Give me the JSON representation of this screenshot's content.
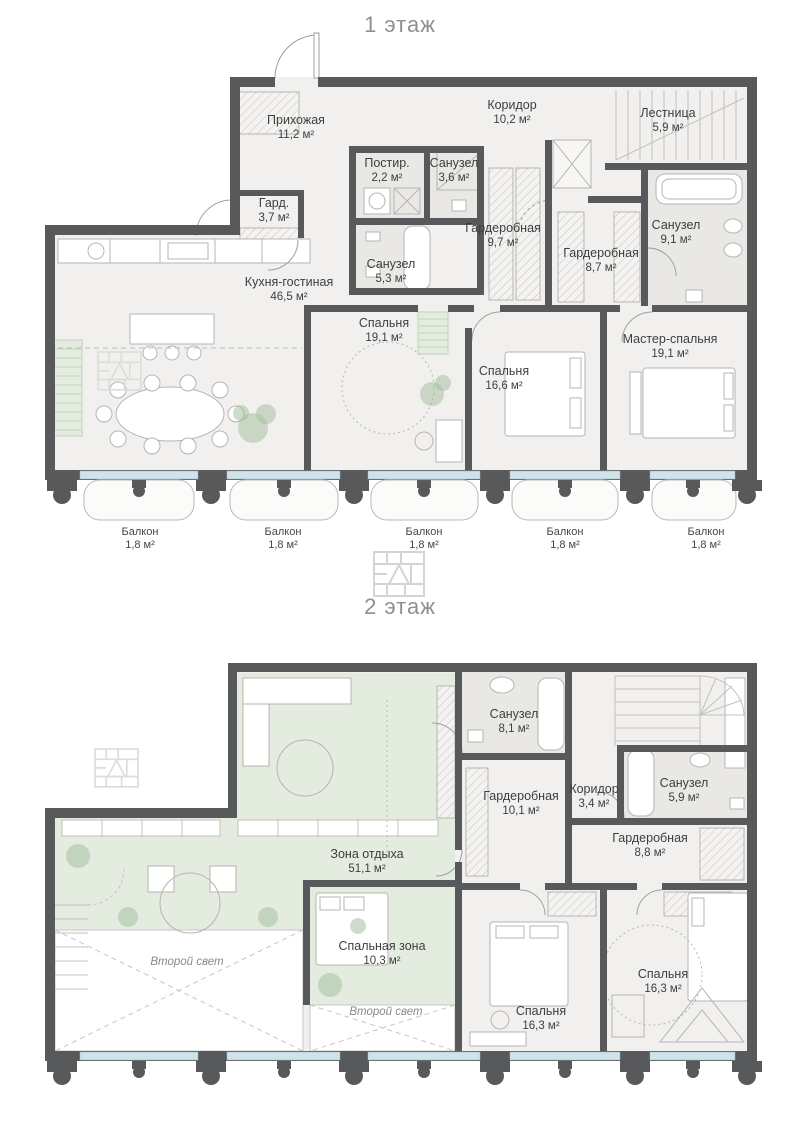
{
  "icons": {
    "brand_logo": "tile-house-logo-watermark"
  },
  "colors": {
    "wall": "#58595b",
    "floor": "#f1f0ee",
    "wet_floor": "#e9e8e5",
    "green_zone": "#e3ecdf",
    "glass": "#cfe3ea",
    "label_text": "#3e3e3e",
    "muted_text": "#8f8f8f"
  },
  "floor1": {
    "title": "1 этаж",
    "rooms": [
      {
        "name": "Прихожая",
        "area": "11,2 м²"
      },
      {
        "name": "Коридор",
        "area": "10,2 м²"
      },
      {
        "name": "Лестница",
        "area": "5,9 м²"
      },
      {
        "name": "Постир.",
        "area": "2,2 м²"
      },
      {
        "name": "Санузел",
        "area": "3,6 м²"
      },
      {
        "name": "Гард.",
        "area": "3,7 м²"
      },
      {
        "name": "Гардеробная",
        "area": "9,7 м²"
      },
      {
        "name": "Гардеробная",
        "area": "8,7 м²"
      },
      {
        "name": "Санузел",
        "area": "9,1 м²"
      },
      {
        "name": "Санузел",
        "area": "5,3 м²"
      },
      {
        "name": "Кухня-гостиная",
        "area": "46,5 м²"
      },
      {
        "name": "Спальня",
        "area": "19,1 м²"
      },
      {
        "name": "Спальня",
        "area": "16,6 м²"
      },
      {
        "name": "Мастер-спальня",
        "area": "19,1 м²"
      }
    ],
    "balconies": [
      {
        "name": "Балкон",
        "area": "1,8 м²"
      },
      {
        "name": "Балкон",
        "area": "1,8 м²"
      },
      {
        "name": "Балкон",
        "area": "1,8 м²"
      },
      {
        "name": "Балкон",
        "area": "1,8 м²"
      },
      {
        "name": "Балкон",
        "area": "1,8 м²"
      }
    ]
  },
  "floor2": {
    "title": "2 этаж",
    "rooms": [
      {
        "name": "Санузел",
        "area": "8,1 м²"
      },
      {
        "name": "Гардеробная",
        "area": "10,1 м²"
      },
      {
        "name": "Коридор",
        "area": "3,4 м²"
      },
      {
        "name": "Санузел",
        "area": "5,9 м²"
      },
      {
        "name": "Гардеробная",
        "area": "8,8 м²"
      },
      {
        "name": "Зона отдыха",
        "area": "51,1 м²"
      },
      {
        "name": "Спальная зона",
        "area": "10,3 м²"
      },
      {
        "name": "Спальня",
        "area": "16,3 м²"
      },
      {
        "name": "Спальня",
        "area": "16,3 м²"
      }
    ],
    "voids": [
      {
        "label": "Второй свет"
      },
      {
        "label": "Второй свет"
      }
    ]
  }
}
